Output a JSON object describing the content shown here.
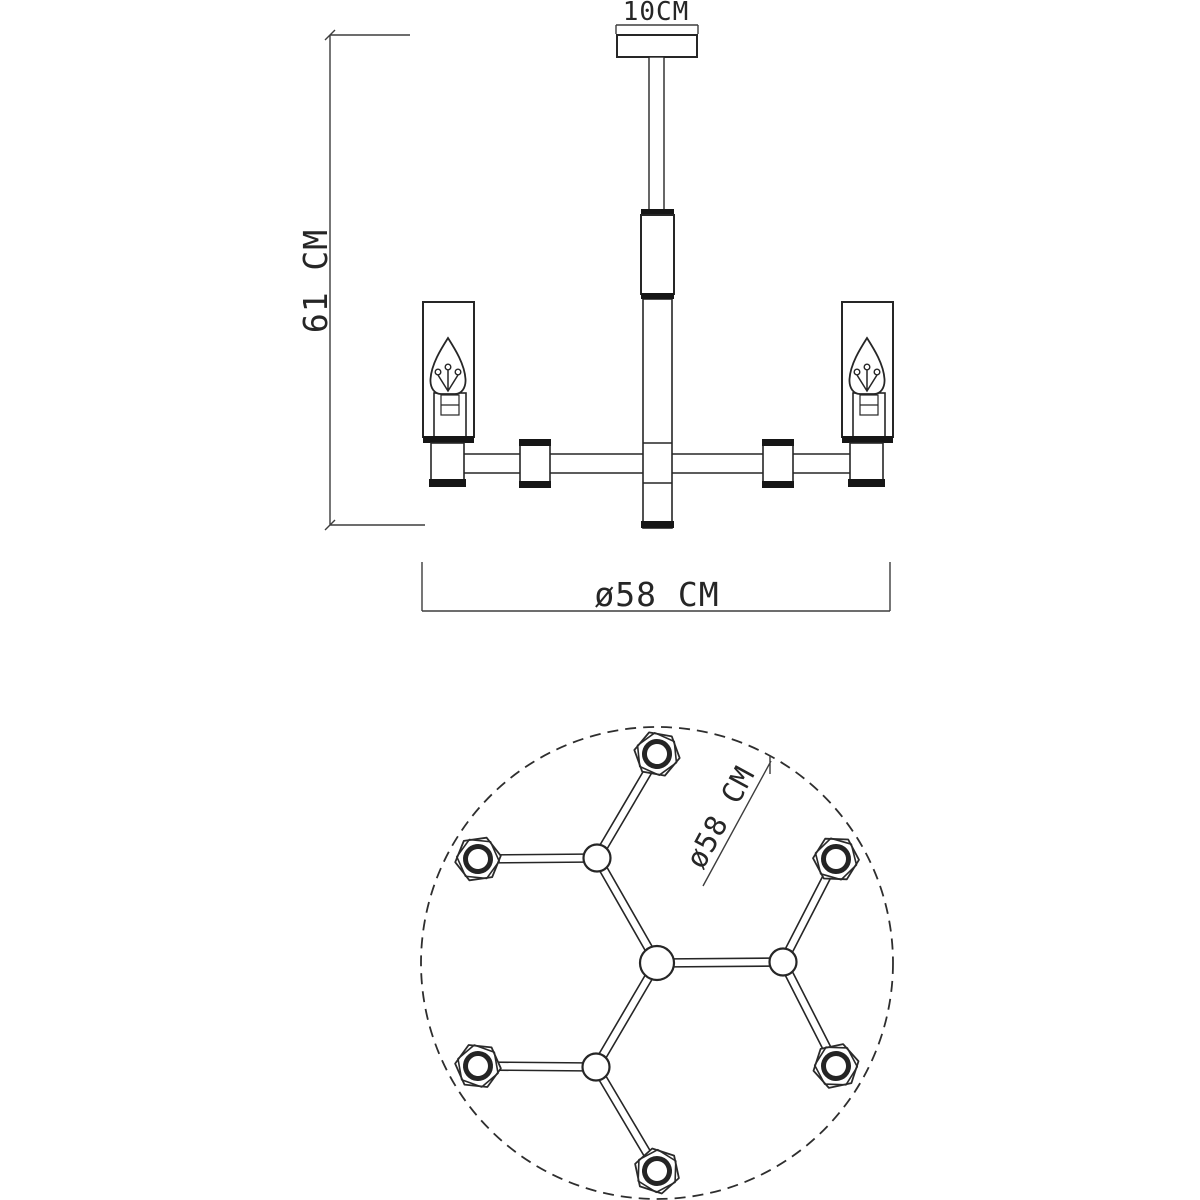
{
  "side_view": {
    "canopy_width_label": "10CM",
    "height_label": "61 CM",
    "diameter_label": "ø58 CM"
  },
  "top_view": {
    "diameter_label": "ø58 CM",
    "lamp_count": 6
  },
  "colors": {
    "line": "#262626",
    "background": "#ffffff"
  }
}
